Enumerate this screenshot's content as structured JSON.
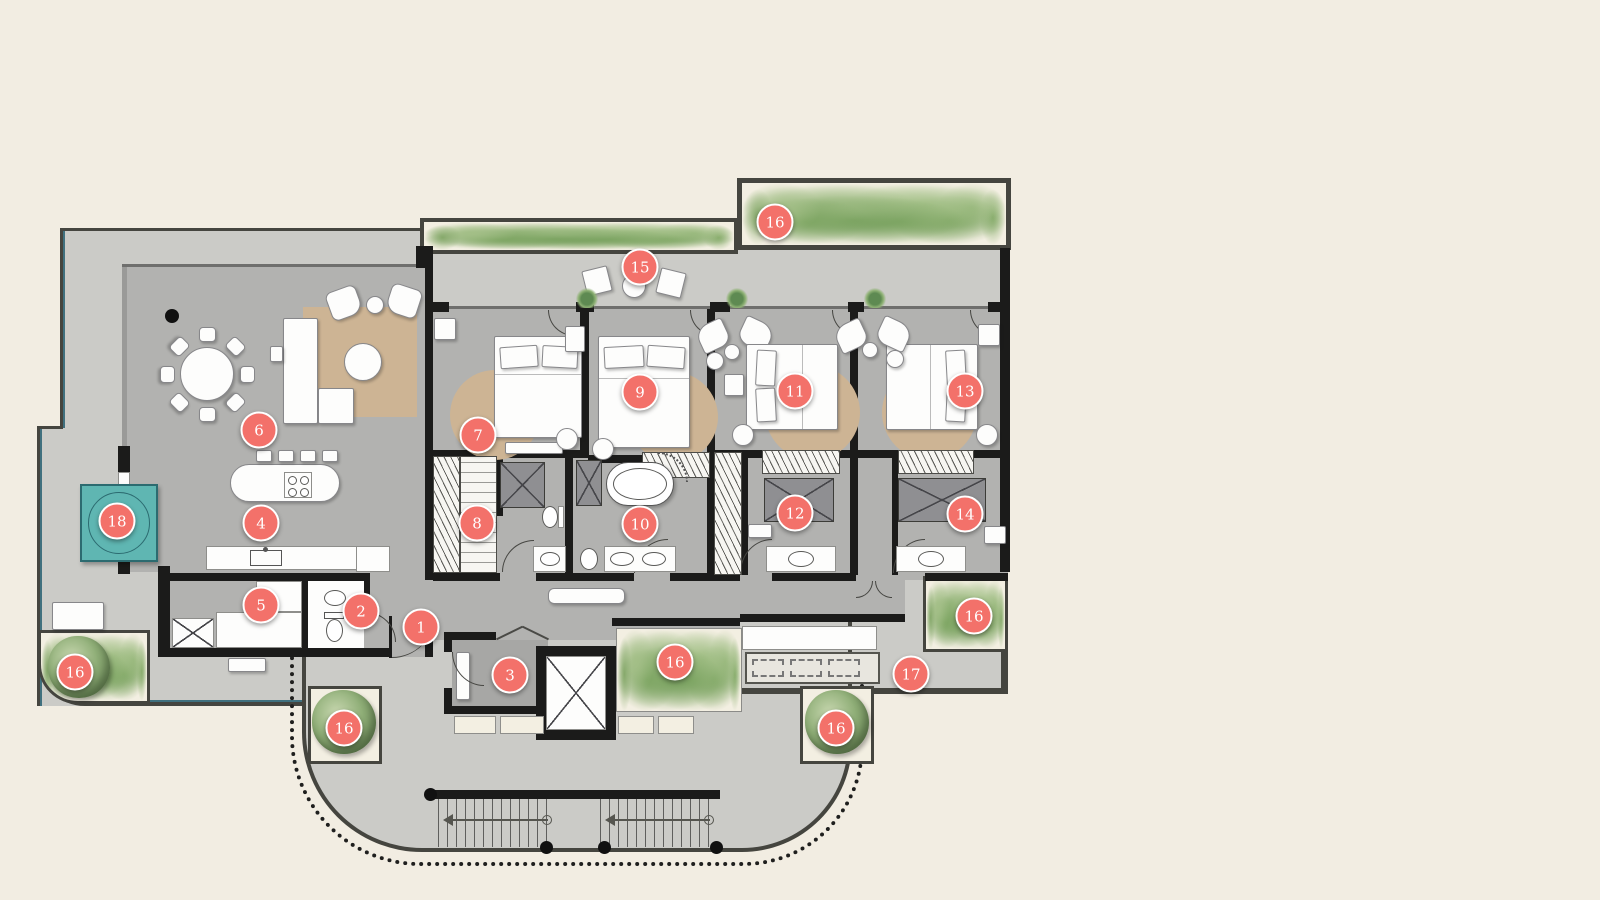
{
  "figure": {
    "type": "architectural-floor-plan"
  },
  "colors": {
    "background": "#f2ede2",
    "terrace": "#cbcbc7",
    "floor": "#b2b2b0",
    "foyer_floor": "#a7a7a5",
    "wall": "#1b1b1a",
    "outline": "#45453f",
    "accent_blue": "#40707e",
    "rug": "#cdb494",
    "pool": "#5fb6b2",
    "pool_line": "#2c6b70",
    "marker_bg": "#f3716a",
    "marker_text": "#ffffff",
    "planter_bg": "#f3efe2",
    "white": "#fdfdfc"
  },
  "markers": [
    {
      "label": "1",
      "x": 421,
      "y": 627
    },
    {
      "label": "2",
      "x": 361,
      "y": 611
    },
    {
      "label": "3",
      "x": 510,
      "y": 675
    },
    {
      "label": "4",
      "x": 261,
      "y": 523
    },
    {
      "label": "5",
      "x": 261,
      "y": 605
    },
    {
      "label": "6",
      "x": 259,
      "y": 430
    },
    {
      "label": "7",
      "x": 478,
      "y": 435
    },
    {
      "label": "8",
      "x": 477,
      "y": 523
    },
    {
      "label": "9",
      "x": 640,
      "y": 392
    },
    {
      "label": "10",
      "x": 640,
      "y": 524
    },
    {
      "label": "11",
      "x": 795,
      "y": 391
    },
    {
      "label": "12",
      "x": 795,
      "y": 513
    },
    {
      "label": "13",
      "x": 965,
      "y": 391
    },
    {
      "label": "14",
      "x": 965,
      "y": 514
    },
    {
      "label": "15",
      "x": 640,
      "y": 267
    },
    {
      "label": "16",
      "x": 775,
      "y": 222
    },
    {
      "label": "16",
      "x": 75,
      "y": 672
    },
    {
      "label": "16",
      "x": 344,
      "y": 728
    },
    {
      "label": "16",
      "x": 675,
      "y": 662
    },
    {
      "label": "16",
      "x": 836,
      "y": 728
    },
    {
      "label": "16",
      "x": 974,
      "y": 616
    },
    {
      "label": "17",
      "x": 911,
      "y": 674
    },
    {
      "label": "18",
      "x": 117,
      "y": 521
    }
  ]
}
